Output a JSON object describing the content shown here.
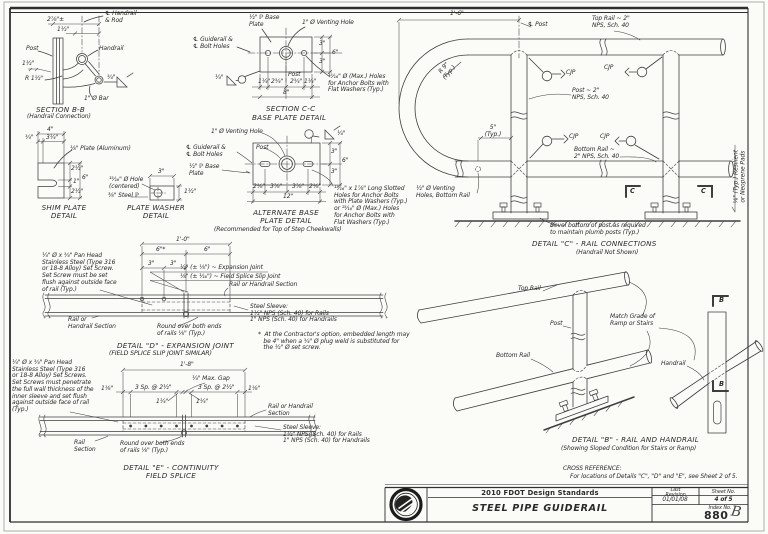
{
  "sheet": {
    "cross_reference": {
      "heading": "CROSS REFERENCE:",
      "text": "For locations of Details \"C\", \"D\" and \"E\", see Sheet 2 of 5."
    },
    "title_block": {
      "standards": "2010 FDOT Design Standards",
      "title": "STEEL PIPE GUIDERAIL",
      "last_revision_label": "Last\nRevision",
      "last_revision": "01/01/08",
      "sheet_no_label": "Sheet No.",
      "sheet_no": "4 of 5",
      "index_no_label": "Index No.",
      "index_no": "880",
      "index_suffix": "B",
      "logo_icon": "fdot-seal"
    }
  },
  "section_bb": {
    "title": "SECTION B-B",
    "subtitle": "(Handrail Connection)",
    "dim_a": "2⅞\"±",
    "dim_b": "1½\"",
    "dim_c": "1½\"",
    "cl_note": "℄ Handrail\n& Rod",
    "post": "Post",
    "handrail": "Handrail",
    "radius": "R 1½\"",
    "bar": "1\" Ø Bar",
    "weld": "¾\""
  },
  "section_cc": {
    "title": "SECTION C-C",
    "subtitle": "BASE PLATE DETAIL",
    "plate_note": "½\" ℙ Base\nPlate",
    "venting_note": "1\" Ø Venting Hole",
    "cl_note": "℄ Guiderail &\n℄ Bolt Holes",
    "weld": "¼\"",
    "post": "Post",
    "holes_note": "¹⁵⁄₁₆\" Ø (Max.) Holes\nfor Anchor Bolts with\nFlat Washers (Typ.)",
    "bottom_dims": [
      "1¼\"",
      "2¾\"",
      "2¾\"",
      "1¼\""
    ],
    "bottom_total": "8\"",
    "right_dims": [
      "3\"",
      "3\""
    ],
    "right_total": "6\""
  },
  "detail_c": {
    "title": "DETAIL \"C\" - RAIL CONNECTIONS",
    "subtitle": "(Handrail Not Shown)",
    "dim_span": "1'-6\"",
    "cl_post": "℄ Post",
    "top_rail": "Top Rail ~ 2\"\nNPS, Sch. 40",
    "post": "Post ~ 2\"\nNPS, Sch. 40",
    "bottom_rail": "Bottom Rail ~\n2\" NPS, Sch. 40",
    "cjp": "CJP",
    "radius": "R 9\"\n(Typ.)",
    "dim_post": "5\"\n(Typ.)",
    "venting": "½\" Ø Venting\nHoles, Bottom Rail",
    "bevel_note": "Bevel bottom of post as required\nto maintain plumb posts (Typ.)",
    "section_mark": "C",
    "pads_note": "⅛\" (Typ.) Resilient\nor Neoprene Pads"
  },
  "shim_plate": {
    "title": "SHIM PLATE\nDETAIL",
    "dim_total_w": "4\"",
    "dim_w1": "¾\"",
    "dim_w2": "3¼\"",
    "plate_note": "⅛\" Plate (Aluminum)",
    "dim_h1": "2½\"",
    "dim_h2": "1\"",
    "dim_h3": "2½\"",
    "dim_total_h": "6\""
  },
  "plate_washer": {
    "title": "PLATE WASHER\nDETAIL",
    "dim_w": "3\"",
    "hole_note": "¹⁵⁄₁₆\" Ø Hole\n(centered)",
    "steel_note": "⅜\" Steel ℙ",
    "dim_h": "1½\""
  },
  "alt_base_plate": {
    "title": "ALTERNATE BASE\nPLATE DETAIL",
    "subtitle": "(Recommended for Top of Step Cheekwalls)",
    "venting_note": "1\" Ø Venting Hole",
    "weld": "¼\"",
    "cl_note": "℄ Guiderail &\n℄ Bolt Holes",
    "post": "Post",
    "plate_note": "½\" ℙ Base\nPlate",
    "bottom_dims": [
      "2⅛\"",
      "3⅞\"",
      "3⅞\"",
      "2⅛\""
    ],
    "bottom_total": "12\"",
    "right_dims": [
      "3\"",
      "3\""
    ],
    "right_total": "6\"",
    "slotted_note": "¹⁵⁄₁₆\" x 1⅞\" Long Slotted\nHoles for Anchor Bolts\nwith Plate Washers (Typ.)\nor ¹⁵⁄₁₆\" Ø (Max.) Holes\nfor Anchor Bolts with\nFlat Washers (Typ.)"
  },
  "detail_d": {
    "title": "DETAIL \"D\" - EXPANSION JOINT",
    "subtitle": "(FIELD SPLICE SLIP JOINT SIMILAR)",
    "set_screw_note": "¼\" Ø x ¾\" Pan Head\nStainless Steel (Type 316\nor 18-8 Alloy) Set Screw.\nSet Screw must be set\nflush against outside face\nof rail (Typ.)",
    "dim_total": "1'-0\"",
    "dim_left": "6\"*",
    "dim_right": "6\"",
    "dim_s1": "3\"",
    "dim_s2": "3\"",
    "expansion_note": "½\" (± ⅛\") ~ Expansion Joint",
    "slip_note": "⅛\" (± ¹⁄₁₆\") ~ Field Splice Slip Joint",
    "rail_label": "Rail or Handrail Section",
    "rail_label_left": "Rail or\nHandrail Section",
    "sleeve_note": "Steel Sleeve:\n1½\" NPS (Sch. 40) for Rails\n1\" NPS (Sch. 40) for Handrails",
    "round_note": "Round over both ends\nof rails ⅛\" (Typ.)",
    "contractor_note": "*  At the Contractor's option, embedded length may\n   be 4\" when a ¾\" Ø plug weld is substituted for\n   the ½\" Ø set screw."
  },
  "detail_e": {
    "title": "DETAIL \"E\" - CONTINUITY\nFIELD SPLICE",
    "set_screw_note": "¼\" Ø x ¾\" Pan Head\nStainless Steel (Type 316\nor 18-8 Alloy) Set Screws.\nSet Screws must penetrate\nthe full wall thickness of the\ninner sleeve and set flush\nagainst outside face of rail\n(Typ.)",
    "dim_total": "1'-8\"",
    "max_gap": "¼\" Max. Gap",
    "dim_e1": "1⅛\"",
    "sp_left": "3 Sp. @ 2½\"",
    "sp_right": "3 Sp. @ 2½\"",
    "dim_e2": "1⅛\"",
    "dim_i1": "1¼\"",
    "dim_i2": "1¼\"",
    "rail_label": "Rail or Handrail\nSection",
    "sleeve_note": "Steel Sleeve:\n1½\" NPS (Sch. 40) for Rails\n1\" NPS (Sch. 40) for Handrails",
    "round_note": "Round over both ends\nof rails ⅛\" (Typ.)",
    "rail_section": "Rail\nSection"
  },
  "detail_b": {
    "title": "DETAIL \"B\" - RAIL AND HANDRAIL",
    "subtitle": "(Showing Sloped Condition for Stairs or Ramp)",
    "top_rail": "Top Rail",
    "post": "Post",
    "bottom_rail": "Bottom Rail",
    "handrail": "Handrail",
    "match_note": "Match Grade of\nRamp or Stairs",
    "section_mark": "B"
  }
}
